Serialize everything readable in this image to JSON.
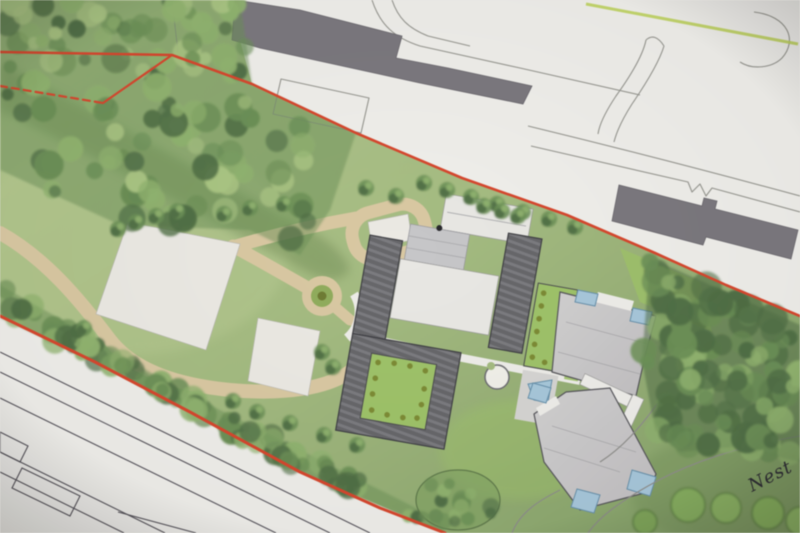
{
  "annotation": {
    "handwritten_note": "Nest"
  },
  "palette": {
    "paper": "#e8e6e2",
    "paper_bright": "#f1f0ec",
    "lawn": "#a4bd7d",
    "lawn_light": "#b5ca8c",
    "lawn_bright": "#9dc463",
    "lawn_dark": "#82a164",
    "meadow_dark": "#6f8e52",
    "tree_dark": "#4e6f42",
    "tree_mid": "#6a9153",
    "tree_light": "#8fb56b",
    "tree_pale": "#a9c77f",
    "path_tan": "#dcc9a0",
    "pad_white": "#edebe5",
    "roof_dark": "#66666a",
    "roof_stripe": "#7b7b7f",
    "roof_white": "#eae9e5",
    "panel_grey": "#c7c7ca",
    "roof_light_a": "#d3d1d2",
    "roof_light_b": "#c2c0c2",
    "skylight_blue": "#a6c9de",
    "boundary_red": "#e04428",
    "context_line": "#96968f",
    "context_building": "#7b787e",
    "road_line": "#55525a",
    "contour_green": "#bcd24e",
    "olive_dot": "#7c8c2f",
    "ink": "#2b2b33"
  }
}
